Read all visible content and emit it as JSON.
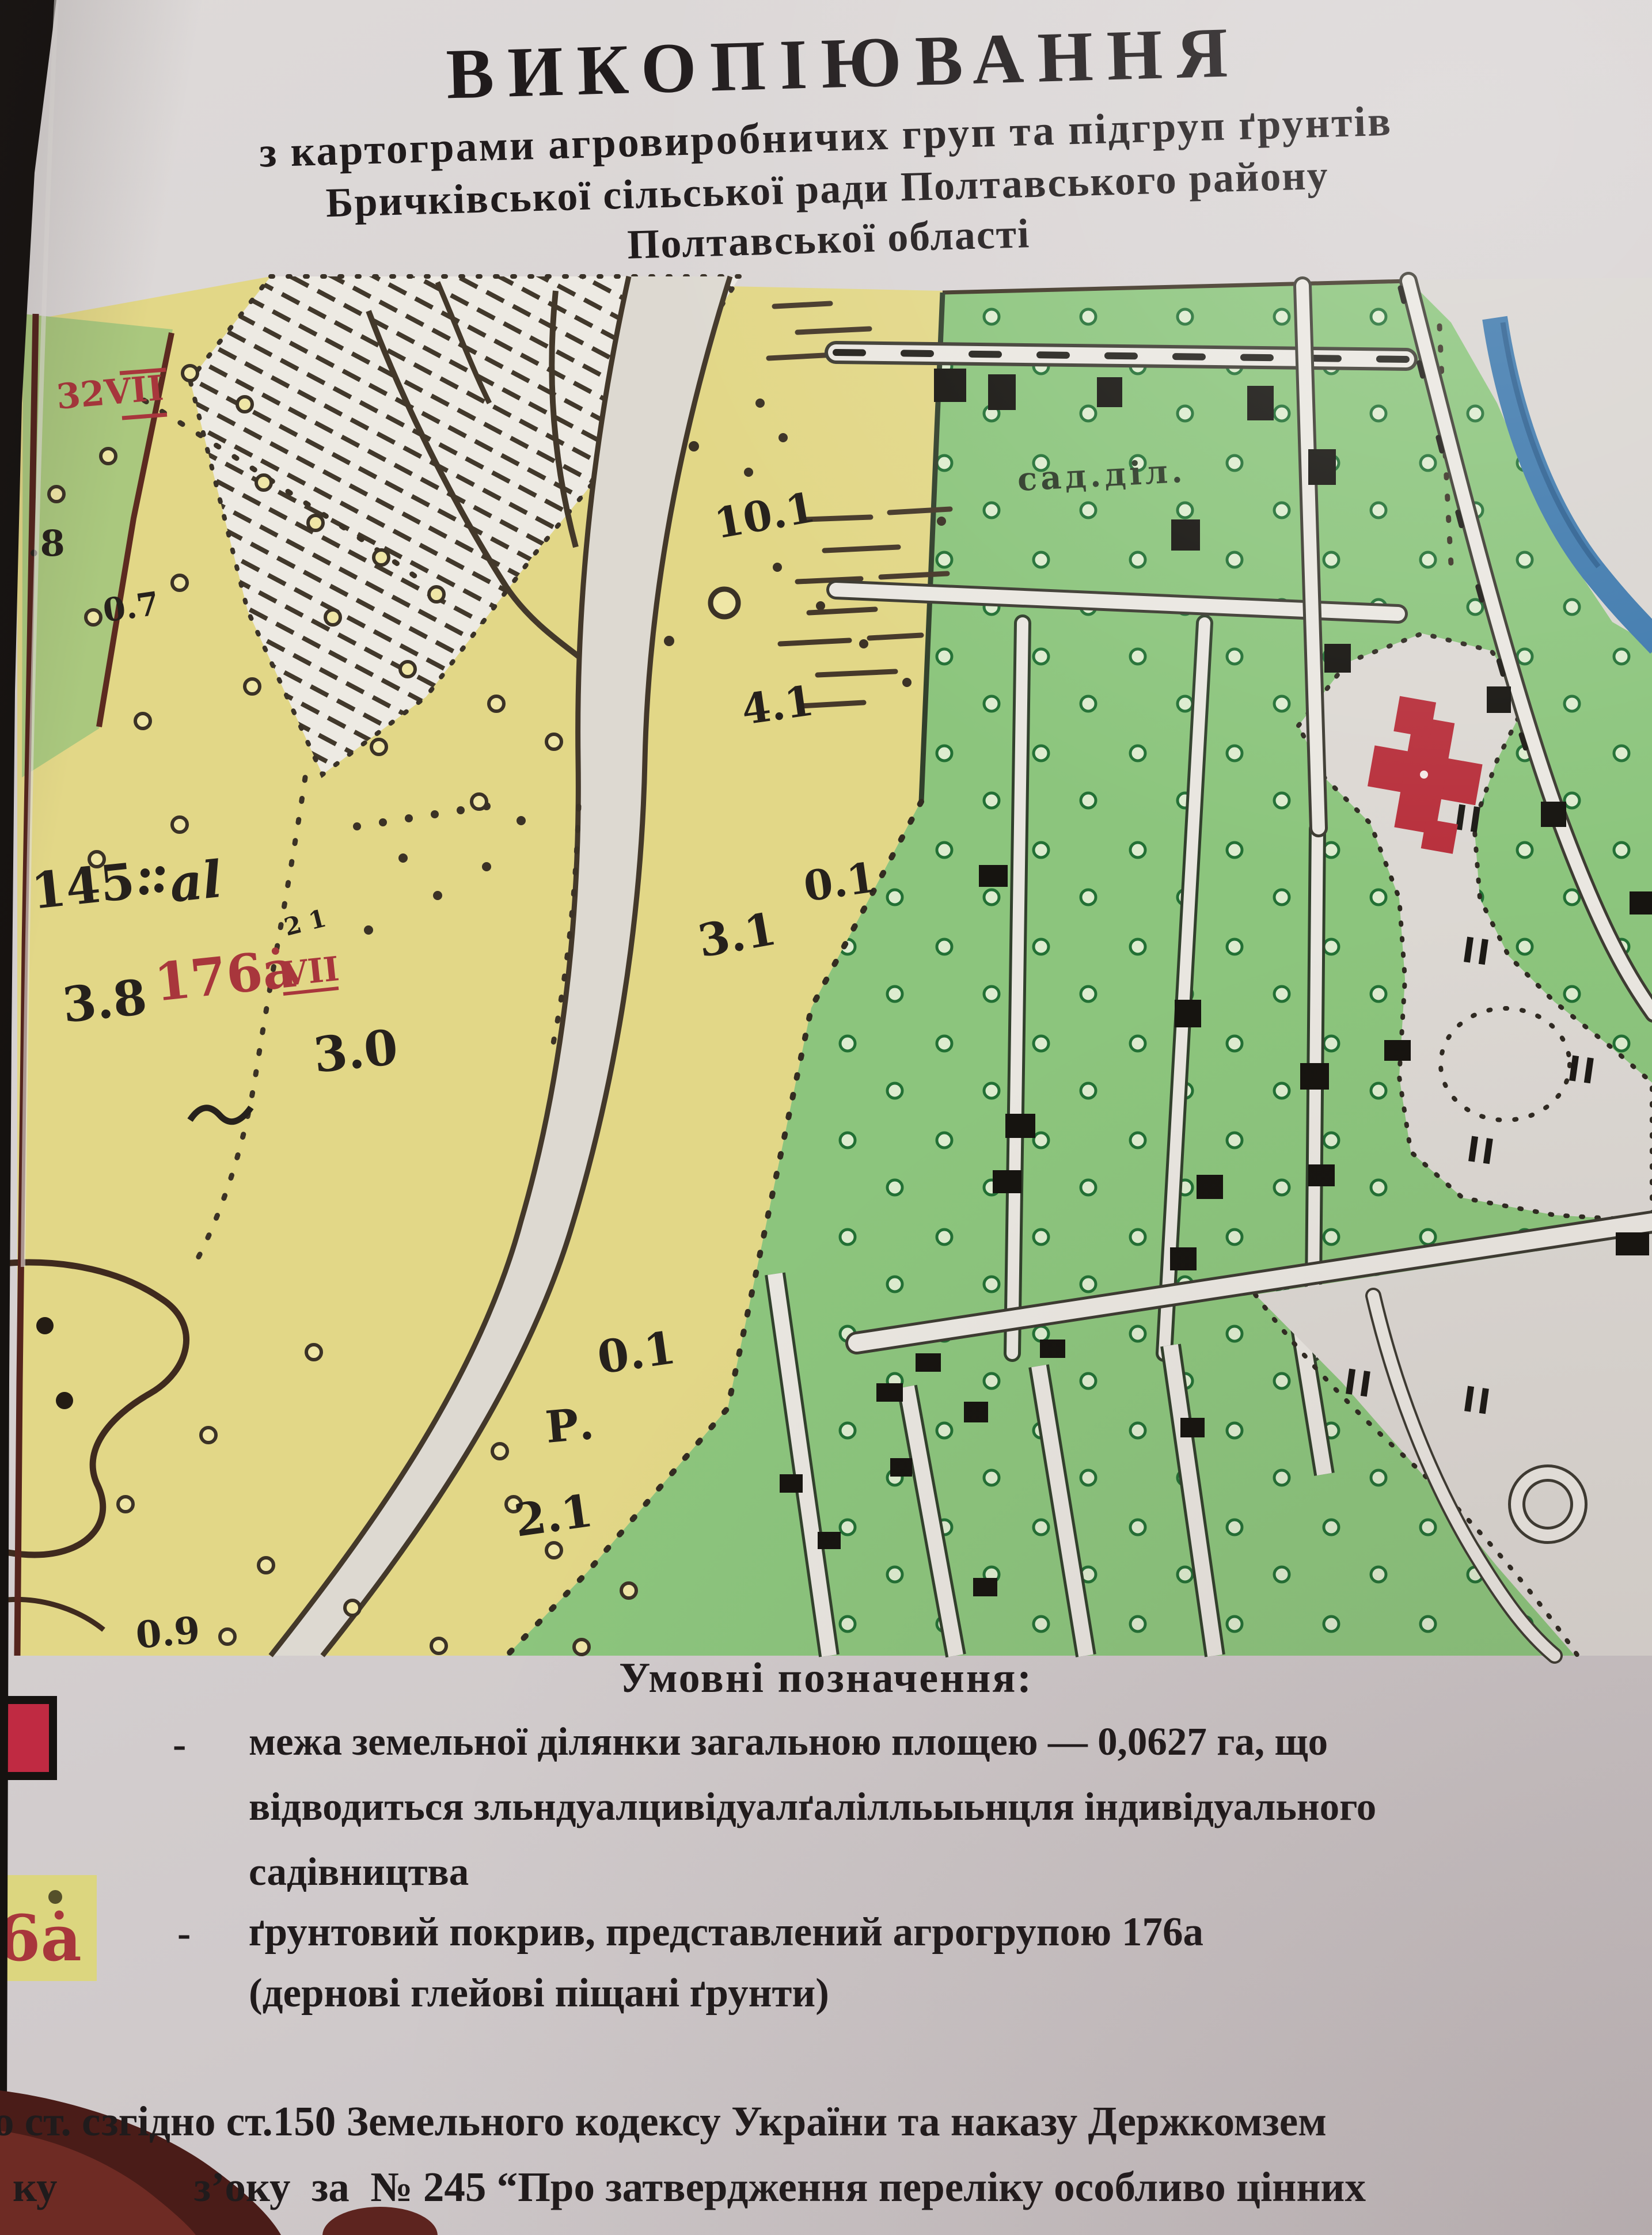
{
  "document": {
    "title": "ВИКОПІЮВАННЯ",
    "subtitle_lines": [
      "з картограми агровиробничих груп та підгруп ґрунтів",
      "Бричківської сільської ради Полтавського району",
      "Полтавської області"
    ]
  },
  "map": {
    "labels": {
      "quarter_mark": "32VII",
      "depth_dot8": ".8",
      "depth_0_7": "0.7",
      "depth_10_1": "10.1",
      "depth_4_1": "4.1",
      "depth_0_1_upper": "0.1",
      "depth_3_1": "3.1",
      "soil_145": "145",
      "soil_145_index": "al",
      "soil_176": "176ȧ",
      "soil_176_sub": "VII",
      "small_marks": "2 1",
      "depth_3_8": "3.8",
      "depth_3_0": "3.0",
      "river_letter": "Р.",
      "depth_2_1": "2.1",
      "depth_0_1_lower": "0.1",
      "depth_0_9": "0.9",
      "garden_plots": "сад.діл."
    },
    "colors": {
      "soil_yellow": "#e2d787",
      "orchard_green": "#8cc57d",
      "river_blue": "#3e79ad",
      "plot_red": "#b8303c",
      "ink": "#3e3425"
    }
  },
  "legend": {
    "heading": "Умовні позначення:",
    "items": [
      {
        "bullet": "-",
        "lines": [
          "межа земельної ділянки загальною площею — 0,0627 га, що",
          "відводиться зльндуалцивідуалґалілльыьнцля індивідуального",
          "садівництва"
        ]
      },
      {
        "bullet": "-",
        "lines": [
          "ґрунтовий покрив, представлений агрогрупою 176а",
          "(дернові глейові піщані ґрунти)"
        ]
      }
    ],
    "agro_symbol_text": "6ȧ"
  },
  "footer": {
    "line1": "о ст. сзгідно ст.150 Земельного кодексу України та наказу Держкомзем",
    "line2": "ку             зʼоку  за  № 245 “Про затвердження переліку особливо цінних"
  }
}
